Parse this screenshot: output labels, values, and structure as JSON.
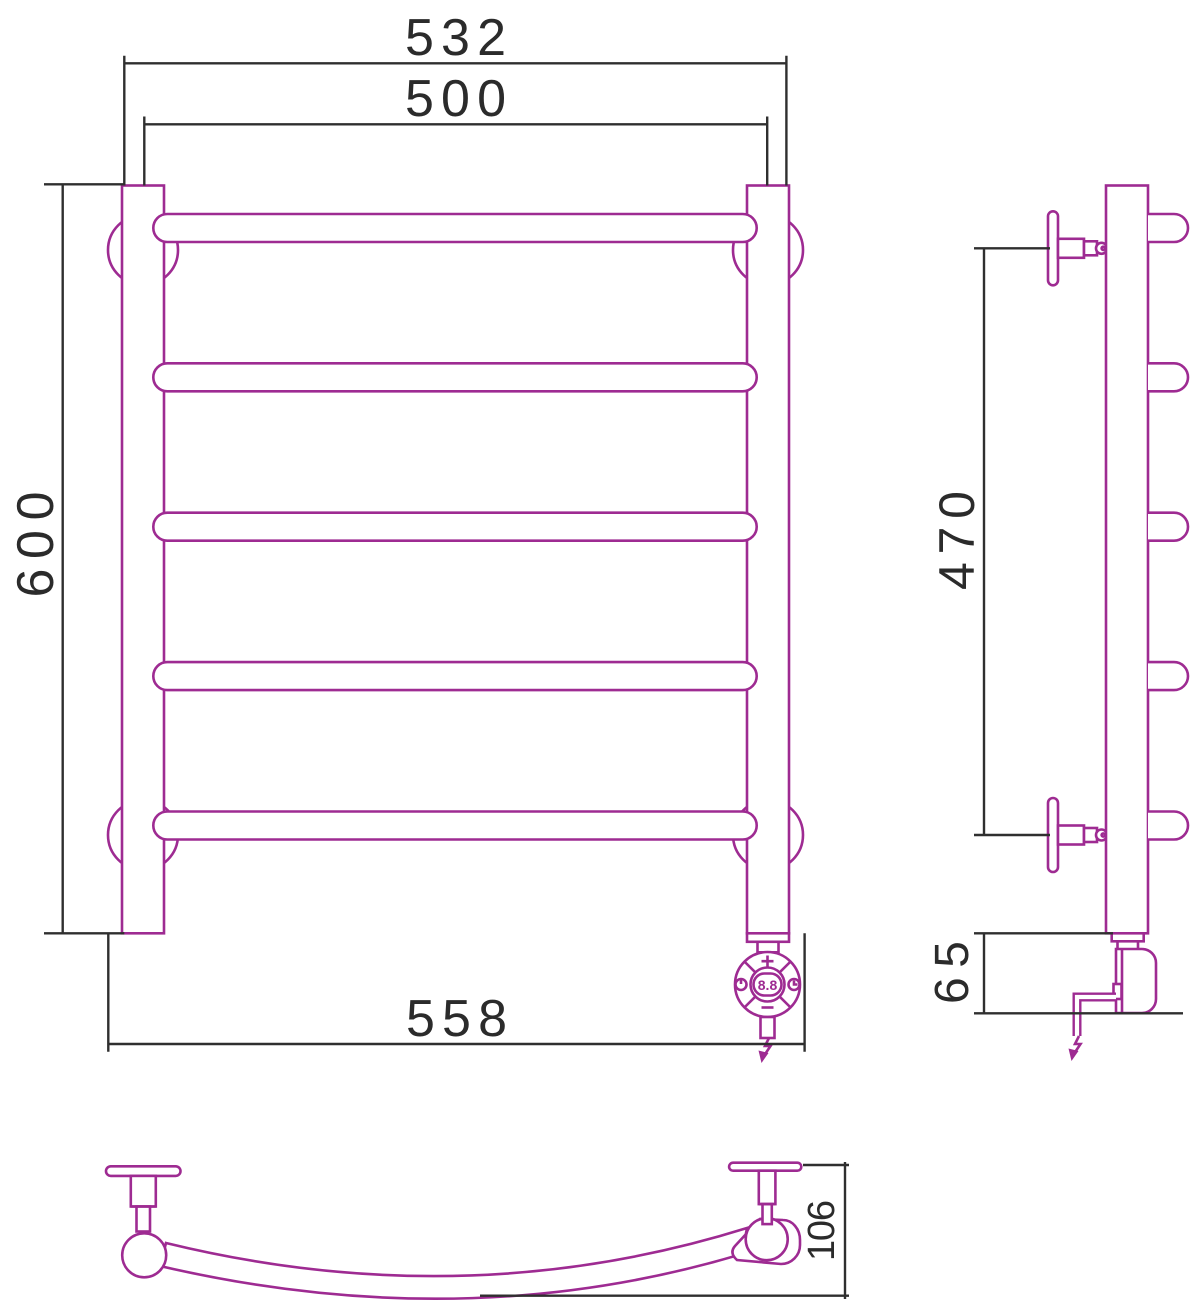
{
  "drawing": {
    "type": "technical-drawing",
    "subject": "ladder towel warmer, three views with dimensions",
    "views": {
      "front": {
        "dim_top_outer": "532",
        "dim_top_centers": "500",
        "dim_height": "600",
        "dim_bottom_overall": "558"
      },
      "side": {
        "dim_bracket_span": "470",
        "dim_heater_height": "65"
      },
      "bottom": {
        "dim_depth": "106"
      }
    },
    "controller": {
      "plus_label": "+",
      "minus_label": "−",
      "display_value": "8.8"
    },
    "colors": {
      "product_outline": "#9e2b92",
      "dimension_lines": "#2f2f2f",
      "background": "#ffffff"
    }
  }
}
